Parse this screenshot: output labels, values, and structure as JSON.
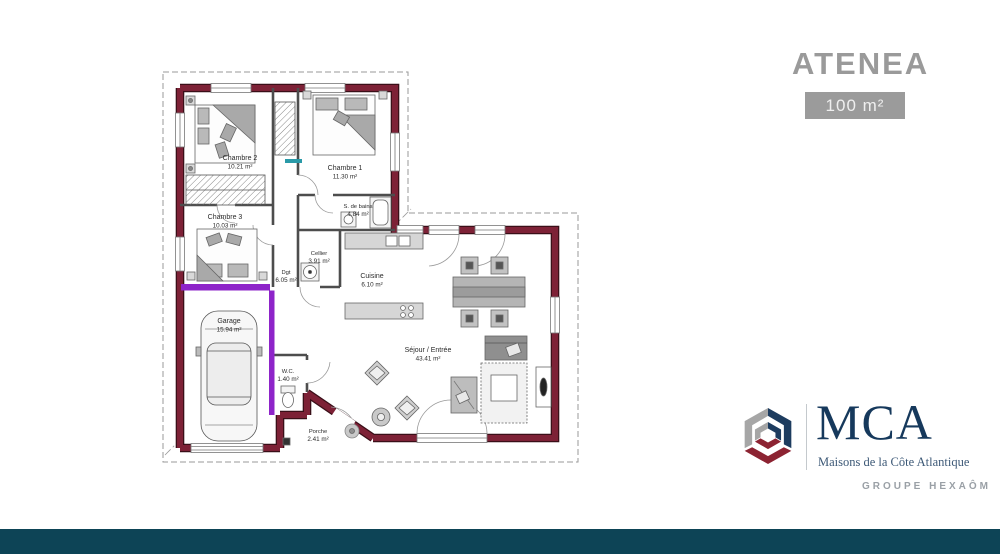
{
  "header": {
    "title": "ATENEA",
    "area_badge": "100 m²"
  },
  "brand": {
    "name": "MCA",
    "tagline": "Maisons de la Côte Atlantique",
    "group": "GROUPE HEXAÔM"
  },
  "colors": {
    "exterior_wall": "#7d2136",
    "highlight_wall": "#8e24c9",
    "window_sill_accent": "#2a9aa8",
    "title_gray": "#9a9a9a",
    "badge_bg": "#9b9b9b",
    "brand_navy": "#16395c",
    "brand_crimson": "#8c2332",
    "bottom_bar": "#0d4456"
  },
  "plan": {
    "rooms": [
      {
        "id": "chambre2",
        "name": "Chambre 2",
        "area": "10.21 m²"
      },
      {
        "id": "chambre1",
        "name": "Chambre 1",
        "area": "11.30 m²"
      },
      {
        "id": "chambre3",
        "name": "Chambre 3",
        "area": "10.03 m²"
      },
      {
        "id": "sdb",
        "name": "S. de bains",
        "area": "4.84 m²"
      },
      {
        "id": "dgt",
        "name": "Dgt",
        "area": "6.05 m²"
      },
      {
        "id": "cellier",
        "name": "Cellier",
        "area": "3.91 m²"
      },
      {
        "id": "cuisine",
        "name": "Cuisine",
        "area": "6.10 m²"
      },
      {
        "id": "garage",
        "name": "Garage",
        "area": "15.94 m²"
      },
      {
        "id": "wc",
        "name": "W.C.",
        "area": "1.40 m²"
      },
      {
        "id": "sejour",
        "name": "Séjour / Entrée",
        "area": "43.41 m²"
      },
      {
        "id": "porche",
        "name": "Porche",
        "area": "2.41 m²"
      }
    ]
  }
}
